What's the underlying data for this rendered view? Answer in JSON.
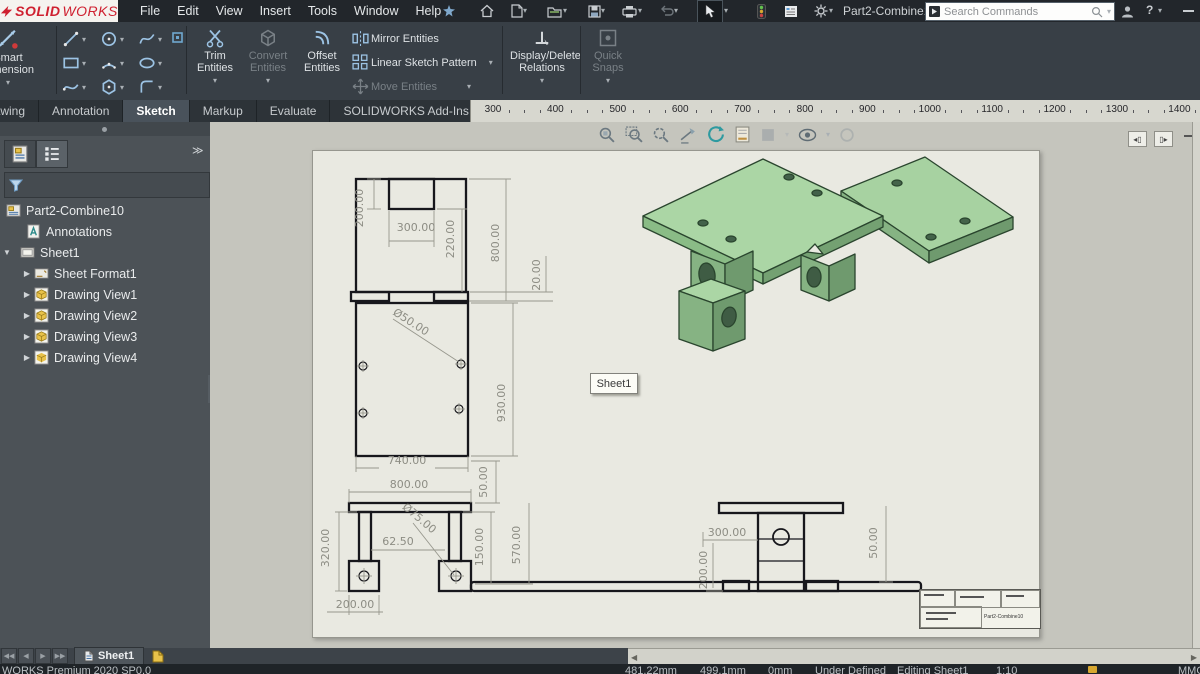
{
  "topbar": {
    "brand": {
      "solid": "SOLID",
      "works": "WORKS"
    },
    "menus": [
      "File",
      "Edit",
      "View",
      "Insert",
      "Tools",
      "Window",
      "Help"
    ],
    "doc_title": "Part2-Combine1...",
    "search_placeholder": "Search Commands"
  },
  "ribbon": {
    "smart_dimension": "Smart Dimension",
    "trim": "Trim Entities",
    "convert": "Convert Entities",
    "offset": "Offset Entities",
    "mirror": "Mirror Entities",
    "linear_pattern": "Linear Sketch Pattern",
    "move": "Move Entities",
    "display_delete": "Display/Delete Relations",
    "quick_snaps": "Quick Snaps"
  },
  "tabs": {
    "items": [
      "Drawing",
      "Annotation",
      "Sketch",
      "Markup",
      "Evaluate",
      "SOLIDWORKS Add-Ins",
      "Sheet Format"
    ],
    "active": "Sketch"
  },
  "ruler": {
    "labels": [
      "300",
      "400",
      "500",
      "600",
      "700",
      "800",
      "900",
      "1000",
      "1100",
      "1200",
      "1300",
      "1400"
    ]
  },
  "tree": {
    "root": "Part2-Combine10",
    "items": [
      {
        "label": "Annotations"
      },
      {
        "label": "Sheet1"
      },
      {
        "label": "Sheet Format1"
      },
      {
        "label": "Drawing View1"
      },
      {
        "label": "Drawing View2"
      },
      {
        "label": "Drawing View3"
      },
      {
        "label": "Drawing View4"
      }
    ]
  },
  "canvas": {
    "tooltip": "Sheet1",
    "title_block": {
      "part": "Part2-Combine10"
    }
  },
  "dims": {
    "d200": "200.00",
    "d300": "300.00",
    "d220": "220.00",
    "d800v": "800.00",
    "d20": "20.00",
    "dia50": "Ø50.00",
    "d930": "930.00",
    "d740": "740.00",
    "d800w": "800.00",
    "d50a": "50.00",
    "d320": "320.00",
    "d6250": "62.50",
    "dia75": "Ø75.00",
    "d150": "150.00",
    "d570": "570.00",
    "d50b": "50.00",
    "d200b": "200.00",
    "d300s": "300.00",
    "d200s": "200.00"
  },
  "sheetbar": {
    "tab": "Sheet1"
  },
  "statusbar": {
    "app": "WORKS Premium 2020 SP0.0",
    "x": "481.22mm",
    "y": "499.1mm",
    "z": "0mm",
    "state": "Under Defined",
    "editing": "Editing Sheet1",
    "scale": "1:10",
    "units": "MMGS"
  },
  "colors": {
    "accent_red": "#cf2030",
    "plate_green": "#abd6a5",
    "panel_dark": "#4c5257"
  }
}
